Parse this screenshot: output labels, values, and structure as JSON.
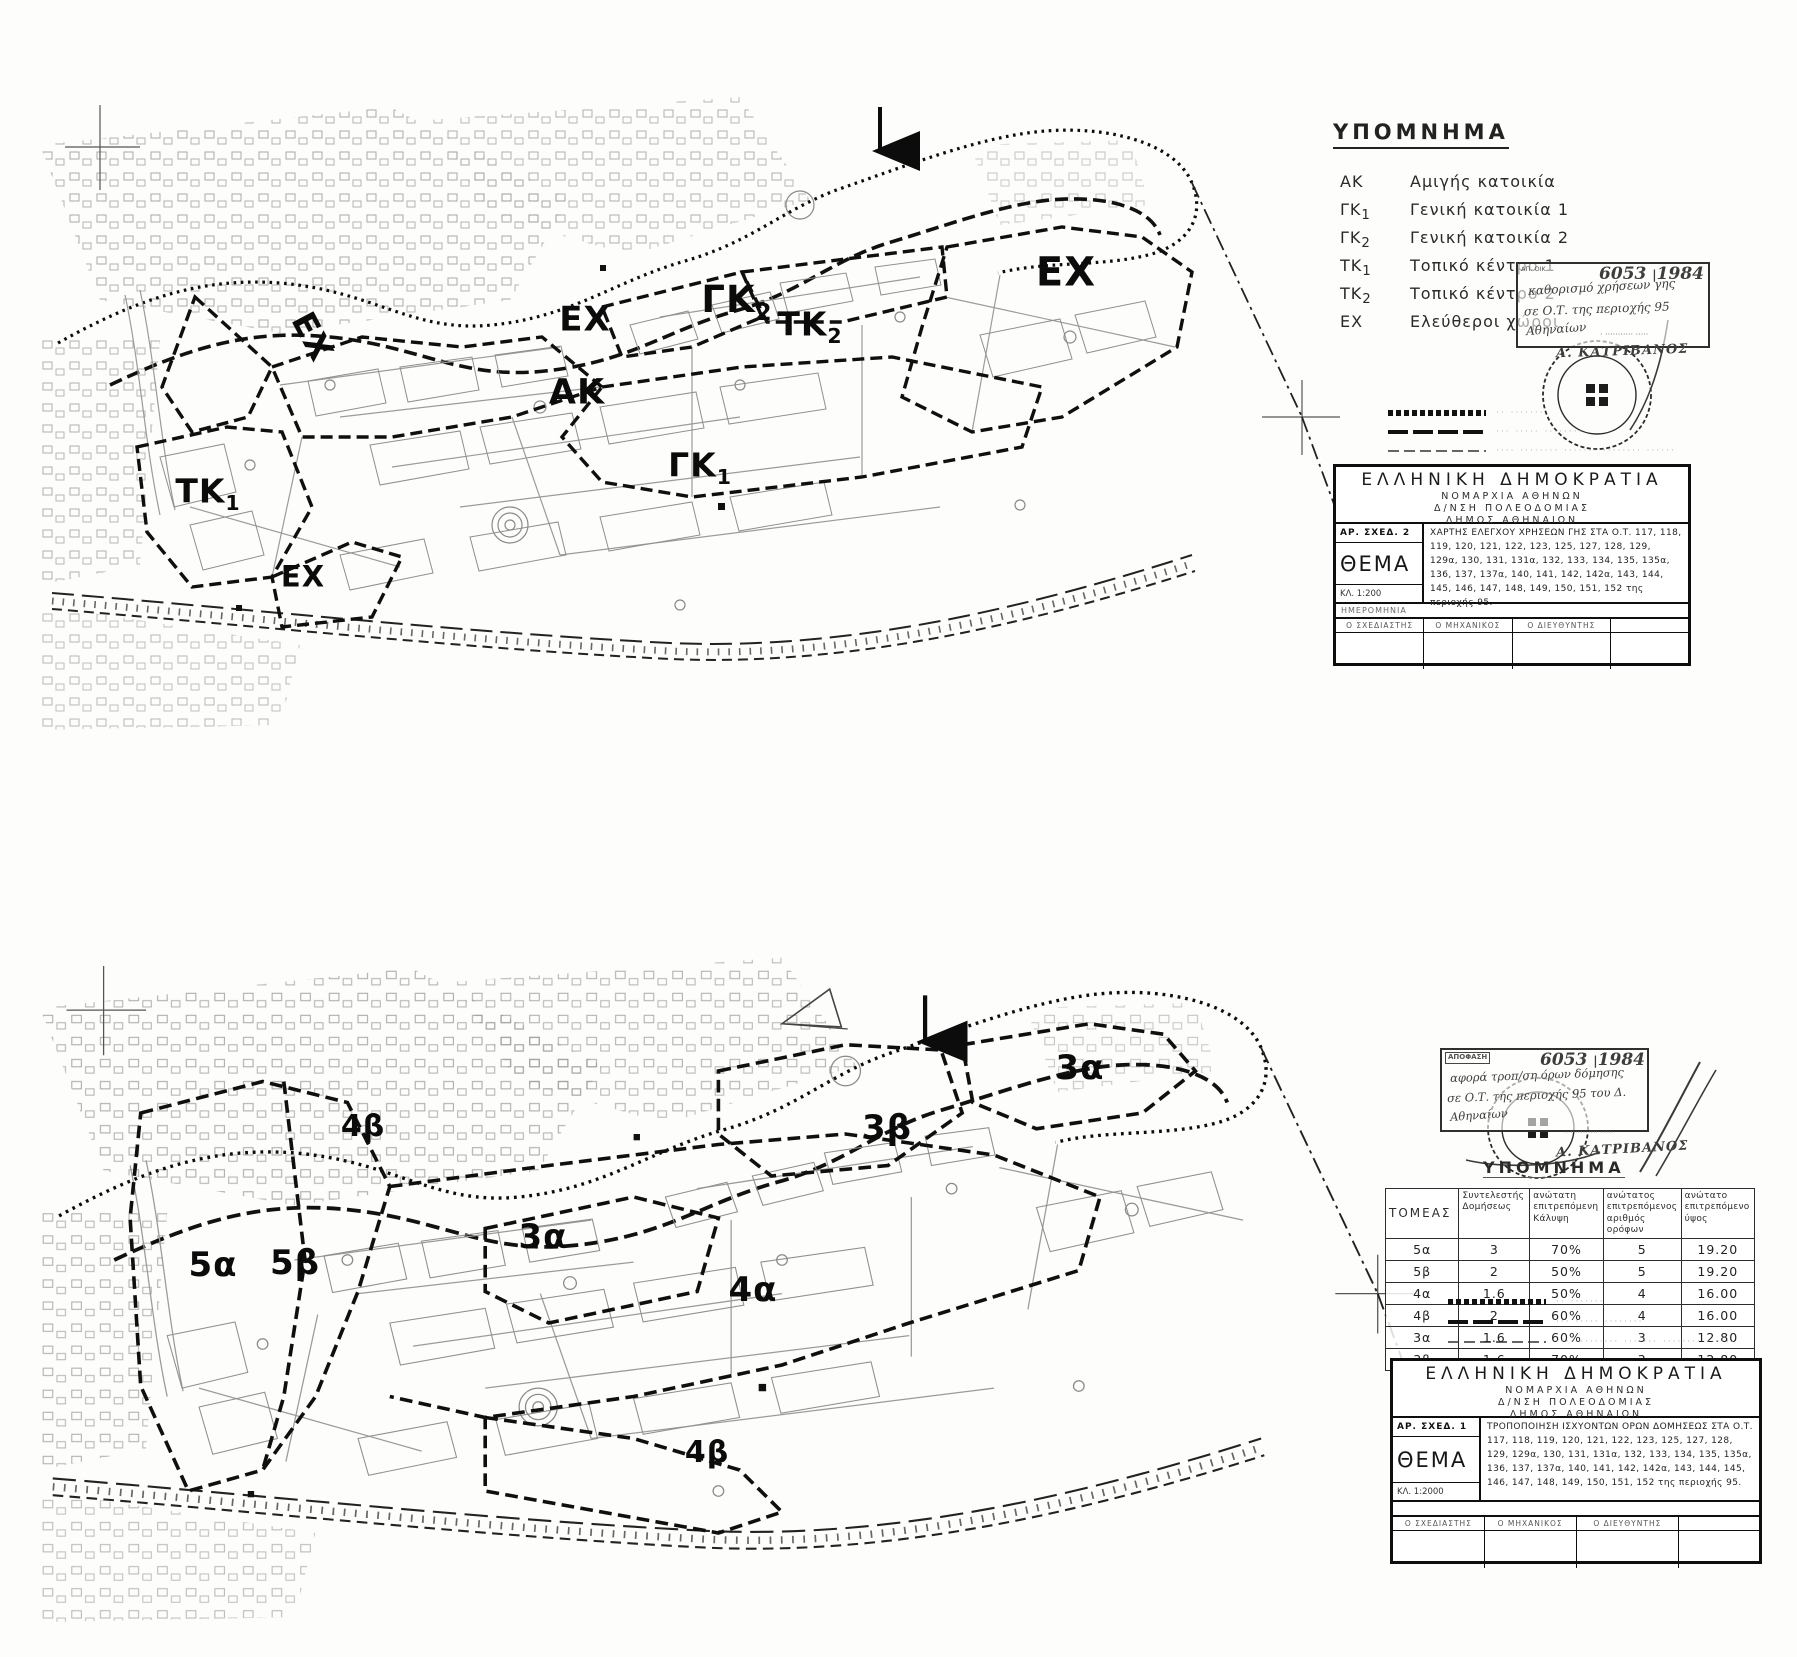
{
  "legend_top": {
    "title": "ΥΠΟΜΝΗΜΑ",
    "items": [
      {
        "code": "ΑΚ",
        "sub": "",
        "label": "Αμιγής κατοικία"
      },
      {
        "code": "ΓΚ",
        "sub": "1",
        "label": "Γενική κατοικία 1"
      },
      {
        "code": "ΓΚ",
        "sub": "2",
        "label": "Γενική κατοικία 2"
      },
      {
        "code": "ΤΚ",
        "sub": "1",
        "label": "Τοπικό κέντρο 1"
      },
      {
        "code": "ΤΚ",
        "sub": "2",
        "label": "Τοπικό κέντρο 2"
      },
      {
        "code": "ΕΧ",
        "sub": "",
        "label": "Ελεύθεροι χώροι"
      }
    ]
  },
  "legend_bottom_title": "ΥΠΟΜΝΗΜΑ",
  "line_legend": {
    "row1": "·· ·······",
    "row2": "··· ····· ········",
    "row3": "···· ········ ······· ········ ······"
  },
  "stamp_top": {
    "corner": "ΑΠ. ΟΙΚ.",
    "number": "6053",
    "year": "1984",
    "line1": "καθορισμό χρήσεων γης",
    "line2": "σε Ο.Τ. της περιοχής 95",
    "line3": "Αθηναίων",
    "approver": "· ··········· ·····",
    "signature": "Α. ΚΑΤΡΙΒΑΝΟΣ"
  },
  "stamp_bottom": {
    "header": "ΑΠΟΦΑΣΗ",
    "number": "6053",
    "year": "1984",
    "line1": "αφορά τροπ/ση όρων δόμησης",
    "line2": "σε Ο.Τ. της περιοχής 95 του Δ.",
    "line3": "Αθηναίων",
    "approver": "· ··········· ·····",
    "signature": "Α. ΚΑΤΡΙΒΑΝΟΣ"
  },
  "titleblock_top": {
    "l1": "ΕΛΛΗΝΙΚΗ ΔΗΜΟΚΡΑΤΙΑ",
    "l2": "ΝΟΜΑΡΧΙΑ ΑΘΗΝΩΝ",
    "l3": "Δ/ΝΣΗ ΠΟΛΕΟΔΟΜΙΑΣ",
    "l4": "ΔΗΜΟΣ ΑΘΗΝΑΙΩΝ",
    "ar_sxed": "ΑΡ. ΣΧΕΔ. 2",
    "thema": "ΘΕΜΑ",
    "klimaka": "ΚΛ. 1:200",
    "theme_text": "ΧΑΡΤΗΣ ΕΛΕΓΧΟΥ ΧΡΗΣΕΩΝ ΓΗΣ ΣΤΑ Ο.Τ. 117, 118, 119, 120, 121, 122, 123, 125, 127, 128, 129, 129α, 130, 131, 131α, 132, 133, 134, 135, 135α, 136, 137, 137α, 140, 141, 142, 142α, 143, 144, 145, 146, 147, 148, 149, 150, 151, 152 της περιοχής 95.",
    "date_label": "ΗΜΕΡΟΜΗΝΙΑ",
    "sig1": "Ο ΣΧΕΔΙΑΣΤΗΣ",
    "sig2": "Ο ΜΗΧΑΝΙΚΟΣ",
    "sig3": "Ο ΔΙΕΥΘΥΝΤΗΣ",
    "sig4": ""
  },
  "titleblock_bottom": {
    "l1": "ΕΛΛΗΝΙΚΗ ΔΗΜΟΚΡΑΤΙΑ",
    "l2": "ΝΟΜΑΡΧΙΑ ΑΘΗΝΩΝ",
    "l3": "Δ/ΝΣΗ ΠΟΛΕΟΔΟΜΙΑΣ",
    "l4": "ΔΗΜΟΣ ΑΘΗΝΑΙΩΝ",
    "ar_sxed": "ΑΡ. ΣΧΕΔ. 1",
    "thema": "ΘΕΜΑ",
    "klimaka": "ΚΛ. 1:2000",
    "theme_text": "ΤΡΟΠΟΠΟΙΗΣΗ ΙΣΧΥΟΝΤΩΝ ΟΡΩΝ ΔΟΜΗΣΕΩΣ ΣΤΑ Ο.Τ. 117, 118, 119, 120, 121, 122, 123, 125, 127, 128, 129, 129α, 130, 131, 131α, 132, 133, 134, 135, 135α, 136, 137, 137α, 140, 141, 142, 142α, 143, 144, 145, 146, 147, 148, 149, 150, 151, 152 της περιοχής 95.",
    "date_label": "",
    "sig1": "Ο ΣΧΕΔΙΑΣΤΗΣ",
    "sig2": "Ο ΜΗΧΑΝΙΚΟΣ",
    "sig3": "Ο ΔΙΕΥΘΥΝΤΗΣ",
    "sig4": ""
  },
  "zoning_table": {
    "headers": {
      "c1": "ΤΟΜΕΑΣ",
      "c2": "Συντελεστής Δομήσεως",
      "c3": "ανώτατη επιτρεπόμενη Κάλυψη",
      "c4": "ανώτατος επιτρεπόμενος αριθμός ορόφων",
      "c5": "ανώτατο επιτρεπόμενο ύψος"
    },
    "rows": [
      [
        "5α",
        "3",
        "70%",
        "5",
        "19.20"
      ],
      [
        "5β",
        "2",
        "50%",
        "5",
        "19.20"
      ],
      [
        "4α",
        "1.6",
        "50%",
        "4",
        "16.00"
      ],
      [
        "4β",
        "2",
        "60%",
        "4",
        "16.00"
      ],
      [
        "3α",
        "1.6",
        "60%",
        "3",
        "12.80"
      ],
      [
        "3β",
        "1.6",
        "70%",
        "3",
        "12.80"
      ]
    ]
  },
  "maps": {
    "top": {
      "labels": [
        {
          "base": "ΕΧ",
          "sub": ""
        },
        {
          "base": "ΕΧ",
          "sub": ""
        },
        {
          "base": "ΓΚ",
          "sub": "2"
        },
        {
          "base": "ΤΚ",
          "sub": "2"
        },
        {
          "base": "ΑΚ",
          "sub": ""
        },
        {
          "base": "ΓΚ",
          "sub": "1"
        },
        {
          "base": "ΤΚ",
          "sub": "1"
        },
        {
          "base": "ΕΧ",
          "sub": ""
        },
        {
          "base": "ΕΧ",
          "sub": ""
        }
      ]
    },
    "bottom": {
      "labels": [
        {
          "base": "3α",
          "sub": ""
        },
        {
          "base": "4β",
          "sub": ""
        },
        {
          "base": "3β",
          "sub": ""
        },
        {
          "base": "3α",
          "sub": ""
        },
        {
          "base": "5α",
          "sub": ""
        },
        {
          "base": "5β",
          "sub": ""
        },
        {
          "base": "4α",
          "sub": ""
        },
        {
          "base": "4β",
          "sub": ""
        }
      ]
    }
  }
}
